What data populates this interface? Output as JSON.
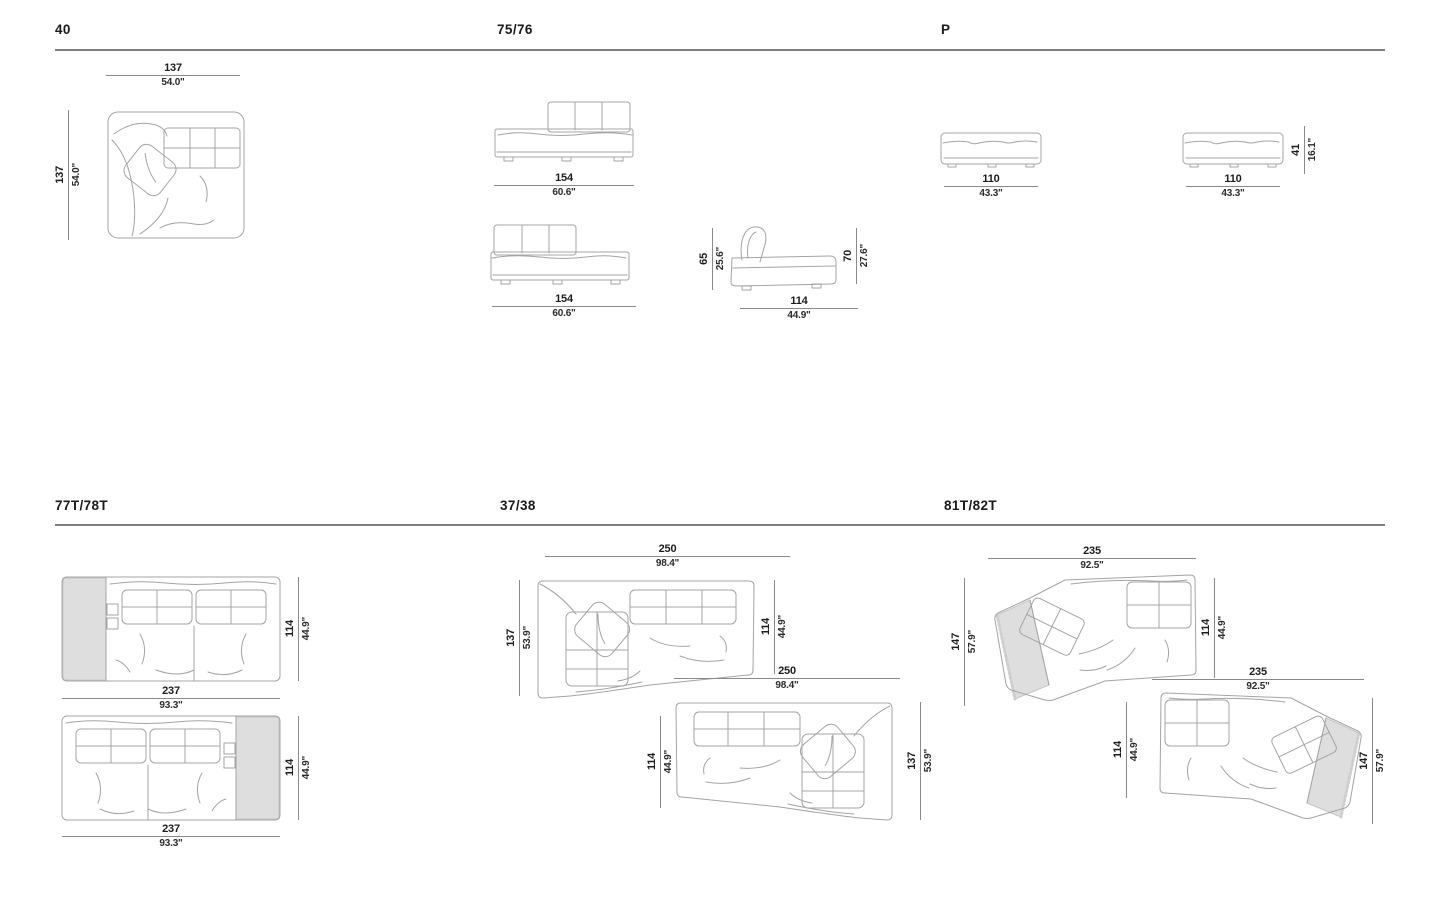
{
  "titles": {
    "s40": "40",
    "s75": "75/76",
    "sp": "P",
    "s77": "77T/78T",
    "s37": "37/38",
    "s81": "81T/82T"
  },
  "dims": {
    "s40_w_cm": "137",
    "s40_w_in": "54.0\"",
    "s40_h_cm": "137",
    "s40_h_in": "54.0\"",
    "s75_a_cm": "154",
    "s75_a_in": "60.6\"",
    "s75_b_cm": "154",
    "s75_b_in": "60.6\"",
    "s75_side_w_cm": "114",
    "s75_side_w_in": "44.9\"",
    "s75_side_hl_cm": "65",
    "s75_side_hl_in": "25.6\"",
    "s75_side_hr_cm": "70",
    "s75_side_hr_in": "27.6\"",
    "sp_a_cm": "110",
    "sp_a_in": "43.3\"",
    "sp_b_cm": "110",
    "sp_b_in": "43.3\"",
    "sp_h_cm": "41",
    "sp_h_in": "16.1\"",
    "s77_a_w_cm": "237",
    "s77_a_w_in": "93.3\"",
    "s77_a_d_cm": "114",
    "s77_a_d_in": "44.9\"",
    "s77_b_w_cm": "237",
    "s77_b_w_in": "93.3\"",
    "s77_b_d_cm": "114",
    "s77_b_d_in": "44.9\"",
    "s37_a_w_cm": "250",
    "s37_a_w_in": "98.4\"",
    "s37_a_l_cm": "137",
    "s37_a_l_in": "53.9\"",
    "s37_a_r_cm": "114",
    "s37_a_r_in": "44.9\"",
    "s37_b_w_cm": "250",
    "s37_b_w_in": "98.4\"",
    "s37_b_l_cm": "114",
    "s37_b_l_in": "44.9\"",
    "s37_b_r_cm": "137",
    "s37_b_r_in": "53.9\"",
    "s81_a_w_cm": "235",
    "s81_a_w_in": "92.5\"",
    "s81_a_l_cm": "147",
    "s81_a_l_in": "57.9\"",
    "s81_a_r_cm": "114",
    "s81_a_r_in": "44.9\"",
    "s81_b_w_cm": "235",
    "s81_b_w_in": "92.5\"",
    "s81_b_l_cm": "114",
    "s81_b_l_in": "44.9\"",
    "s81_b_r_cm": "147",
    "s81_b_r_in": "57.9\""
  },
  "colors": {
    "line_art": "#a4a4a4",
    "dimension_line": "#8a8a8a",
    "text": "#1d1d1d",
    "panel_shade": "#dedede",
    "section_rule": "#7e7e7e",
    "background": "#ffffff"
  }
}
